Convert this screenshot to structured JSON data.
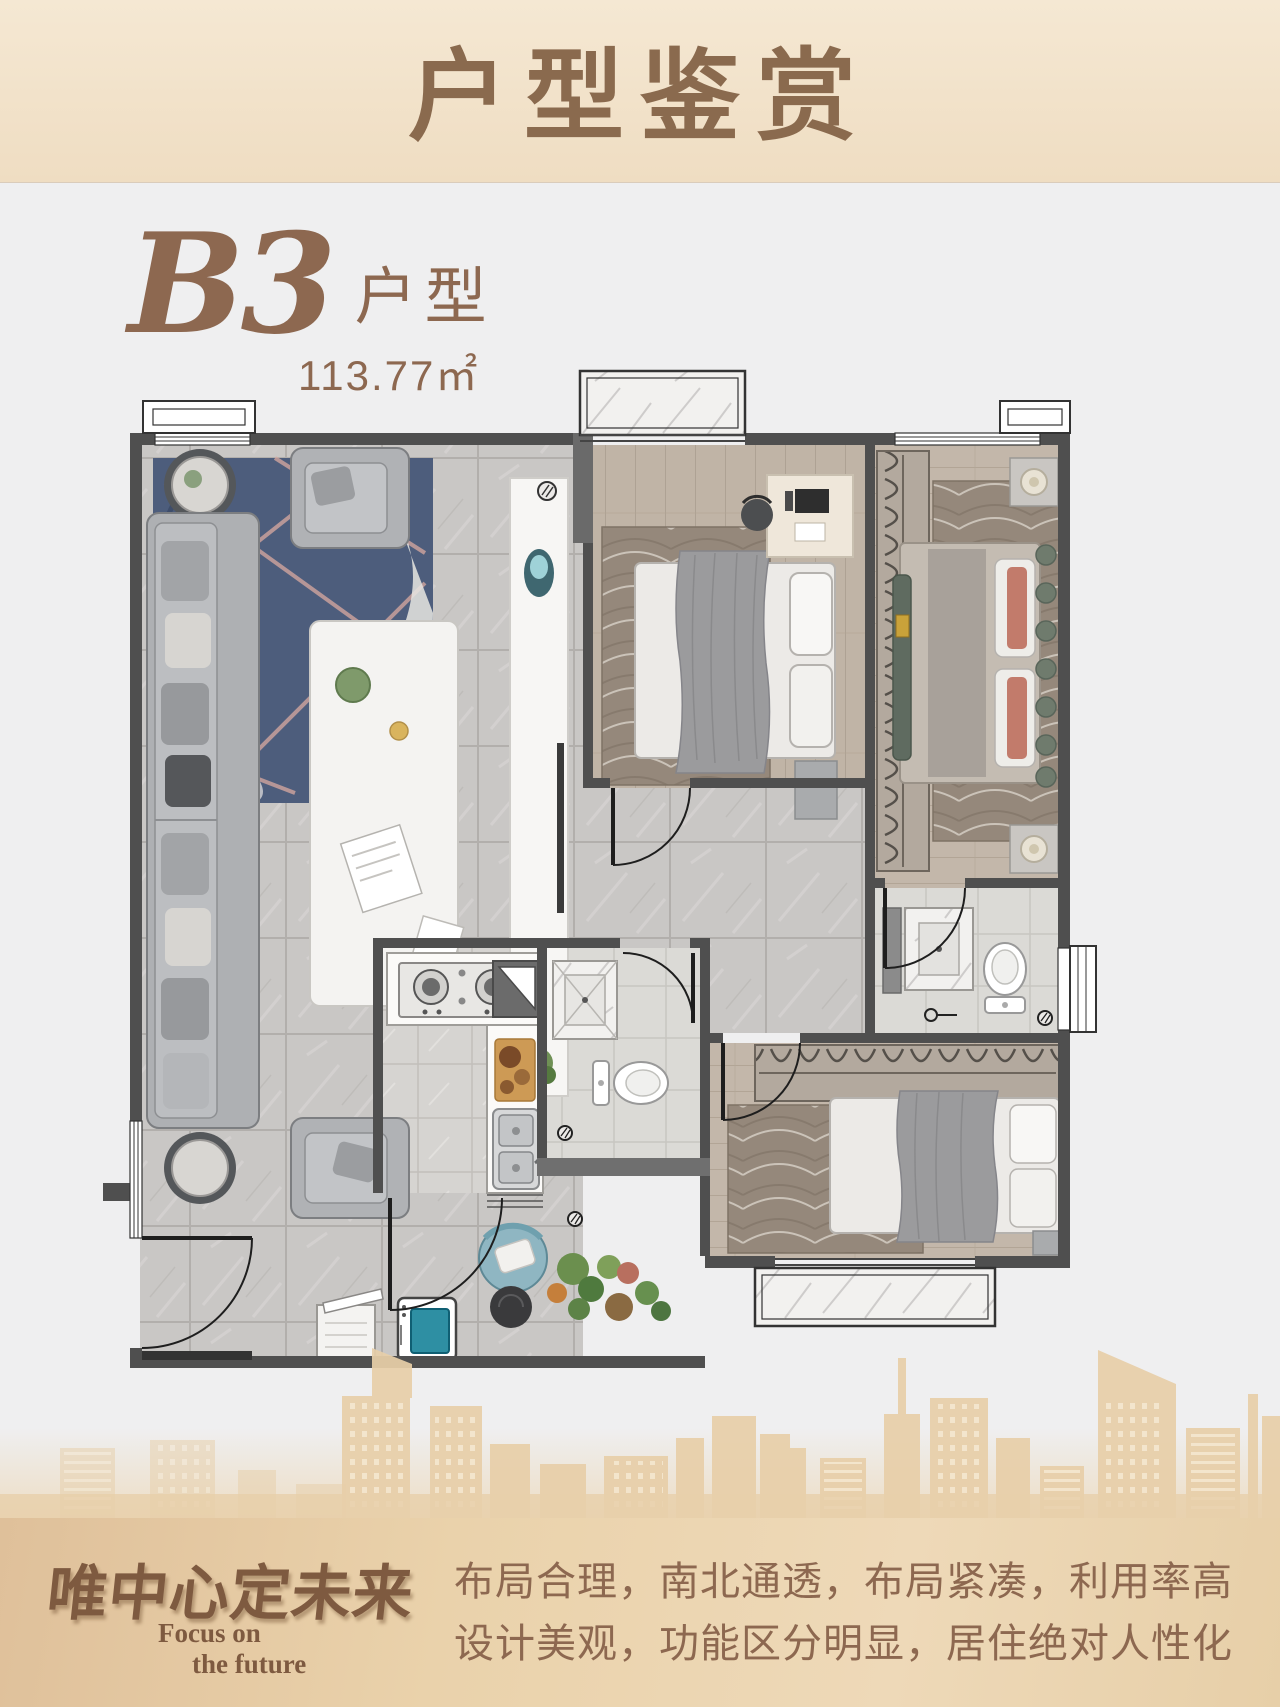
{
  "header": {
    "title": "户型鉴赏"
  },
  "unit": {
    "code": "B3",
    "type_label": "户型",
    "area": "113.77㎡"
  },
  "slogan": {
    "line1": "布局合理，南北通透，布局紧凑，利用率高",
    "line2": "设计美观，功能区分明显，居住绝对人性化"
  },
  "brand": {
    "calligraphy": "唯中心定未来",
    "english_line1": "Focus on",
    "english_line2": "the future"
  },
  "palette": {
    "page_bg": "#efeff0",
    "header_bg_top": "#f5e8d3",
    "header_bg_bottom": "#efddc2",
    "title_brown": "#8a6a4e",
    "accent_brown": "#8d6850",
    "footer_bg_left": "#dfc09a",
    "footer_bg_right": "#eed9b8",
    "skyline": "#e8cfa9",
    "wall_gray": "#4f4f4f",
    "marble_floor": "#c9c7c5",
    "wood_floor": "#c0b4a6",
    "rug_blue": "#4d5d7c",
    "carpet_brown": "#95887b",
    "washer_door_teal": "#2e8fa3"
  }
}
